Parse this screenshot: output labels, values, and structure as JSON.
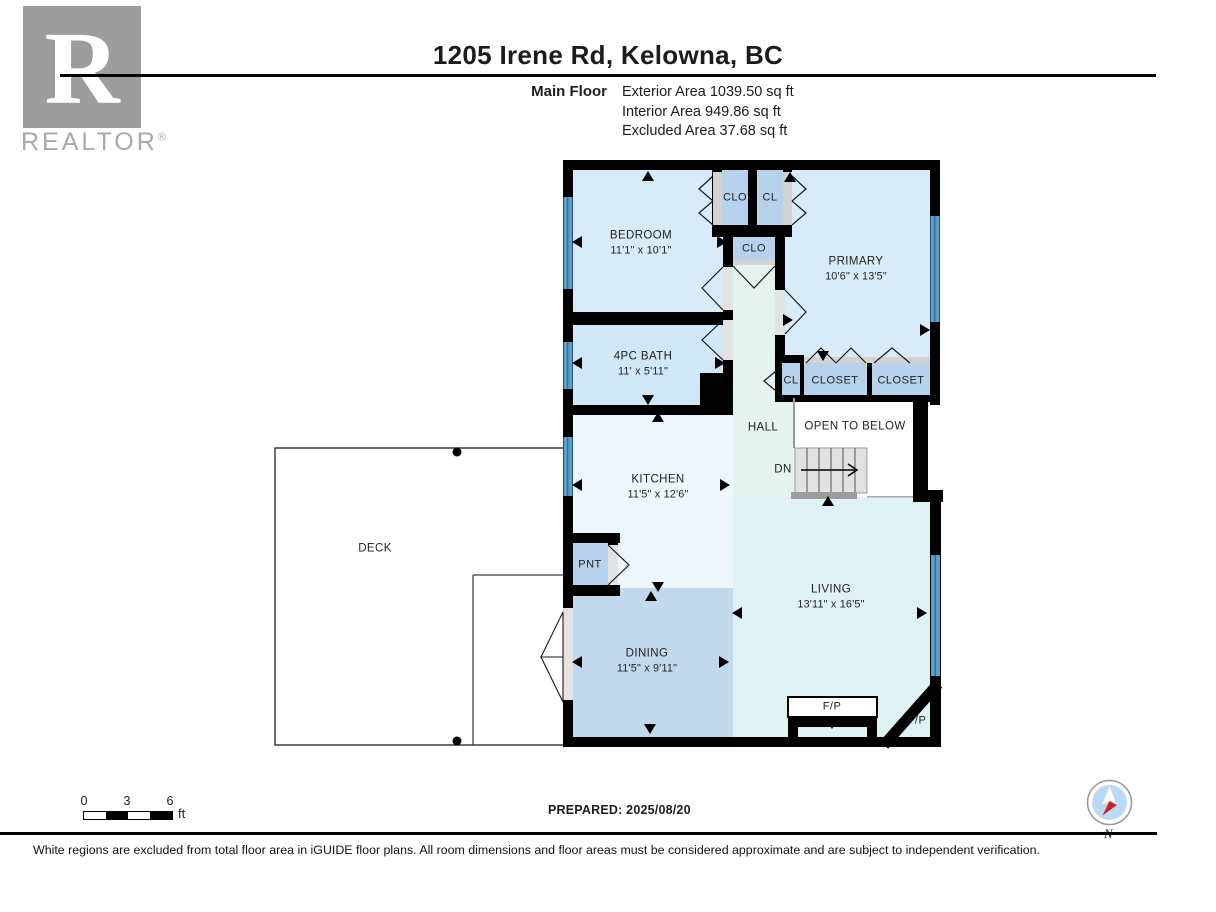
{
  "header": {
    "title": "1205 Irene Rd, Kelowna, BC",
    "floor_label": "Main Floor",
    "area_lines": [
      "Exterior Area 1039.50 sq ft",
      "Interior Area 949.86 sq ft",
      "Excluded Area 37.68 sq ft"
    ]
  },
  "logo": {
    "letter": "R",
    "wordmark": "REALTOR",
    "registered": "®"
  },
  "rooms": {
    "bedroom": {
      "name": "BEDROOM",
      "dims": "11'1\" x 10'1\""
    },
    "primary": {
      "name": "PRIMARY",
      "dims": "10'6\" x 13'5\""
    },
    "bath": {
      "name": "4PC BATH",
      "dims": "11' x 5'11\""
    },
    "kitchen": {
      "name": "KITCHEN",
      "dims": "11'5\" x 12'6\""
    },
    "dining": {
      "name": "DINING",
      "dims": "11'5\" x 9'11\""
    },
    "living": {
      "name": "LIVING",
      "dims": "13'11\" x 16'5\""
    },
    "hall": {
      "name": "HALL"
    },
    "deck": {
      "name": "DECK"
    },
    "open_to_below": {
      "name": "OPEN TO BELOW"
    },
    "stairs_label": "DN"
  },
  "closets": {
    "clo_top": "CLO",
    "cl_top": "CL",
    "clo_hall": "CLO",
    "cl_primary": "CL",
    "closet_a": "CLOSET",
    "closet_b": "CLOSET",
    "pantry": "PNT"
  },
  "fireplaces": {
    "fp_main": "F/P",
    "fp_corner": "F/P"
  },
  "scale_bar": {
    "ticks": [
      "0",
      "3",
      "6"
    ],
    "unit": "ft"
  },
  "prepared_label": "PREPARED: 2025/08/20",
  "compass": {
    "north_label": "N"
  },
  "footer": {
    "disclaimer": "White regions are excluded from total floor area in iGUIDE floor plans. All room dimensions and floor areas must be considered approximate and are subject to independent verification."
  },
  "colors": {
    "wall": "#000000",
    "window": "#5b9fc9",
    "room_blue": "#d8ebf8",
    "room_bath": "#cfe7f7",
    "room_kitchen": "#edf7fb",
    "room_living": "#def1f3",
    "room_hall": "#e4f3ee",
    "room_dining": "#c2d9ed",
    "closet": "#b7d2ec",
    "stairs": "#e1e1e1",
    "compass_red": "#cc2127",
    "compass_blue": "#b9daf0"
  }
}
